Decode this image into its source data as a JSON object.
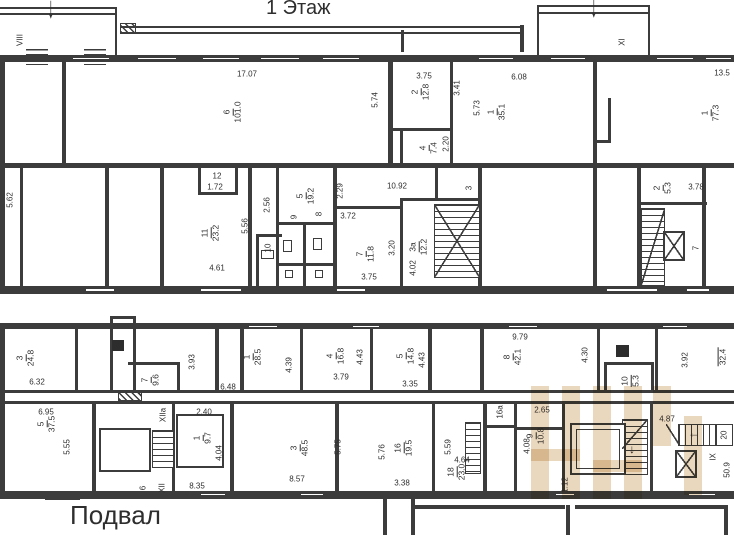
{
  "titles": {
    "floor1": "1 Этаж",
    "basement": "Подвал"
  },
  "icons": {
    "down_arrow": "↓",
    "left_arrow": "←"
  },
  "f1": {
    "entrances": {
      "left": "VIII",
      "right": "XI"
    },
    "rooms": [
      {
        "n": "6",
        "a": "101.0"
      },
      {
        "n": "2",
        "a": "12.8"
      },
      {
        "n": "4",
        "a": "7.4"
      },
      {
        "n": "1",
        "a": "35.1"
      },
      {
        "n": "1",
        "a": "77.3"
      },
      {
        "n": "11",
        "a": "23.2"
      },
      {
        "n": "5",
        "a": "19.2"
      },
      {
        "n": "7",
        "a": "11.8"
      },
      {
        "n": "3а",
        "a": "12.2"
      },
      {
        "n": "2",
        "a": "5.3"
      }
    ],
    "small_rooms": [
      "12",
      "9",
      "8",
      "10",
      "3",
      "7"
    ],
    "dims": [
      "17.07",
      "5.74",
      "3.75",
      "3.41",
      "5.73",
      "2.20",
      "6.08",
      "13.5",
      "5.62",
      "1.72",
      "4.61",
      "5.56",
      "2.56",
      "2.29",
      "10.92",
      "3.72",
      "3.20",
      "3.75",
      "4.02",
      "3.78"
    ]
  },
  "bs": {
    "stairs": [
      "XIIa",
      "XII",
      "IX"
    ],
    "rooms": [
      {
        "n": "3",
        "a": "24.8"
      },
      {
        "n": "7",
        "a": "9.6"
      },
      {
        "n": "1",
        "a": "28.5"
      },
      {
        "n": "4",
        "a": "16.8"
      },
      {
        "n": "5",
        "a": "14.8"
      },
      {
        "n": "8",
        "a": "42.1"
      },
      {
        "n": "10",
        "a": "5.3"
      },
      {
        "n": "5",
        "a": "37.5"
      },
      {
        "n": "1",
        "a": "9.7"
      },
      {
        "n": "3",
        "a": "48.5"
      },
      {
        "n": "16",
        "a": "19.5"
      },
      {
        "n": "18",
        "a": "23.0"
      },
      {
        "n": "9",
        "a": "10.8"
      }
    ],
    "partial_area": "32.4",
    "small_rooms": [
      "6",
      "16а",
      "20"
    ],
    "dims": [
      "6.32",
      "3.93",
      "6.48",
      "4.39",
      "4.43",
      "3.79",
      "4.43",
      "3.35",
      "9.79",
      "4.30",
      "3.92",
      "6.95",
      "5.55",
      "2.40",
      "4.04",
      "8.35",
      "5.75",
      "8.57",
      "5.76",
      "3.38",
      "5.59",
      "4.64",
      "2.65",
      "4.08",
      "1.12",
      "4.87",
      "50.9"
    ]
  }
}
